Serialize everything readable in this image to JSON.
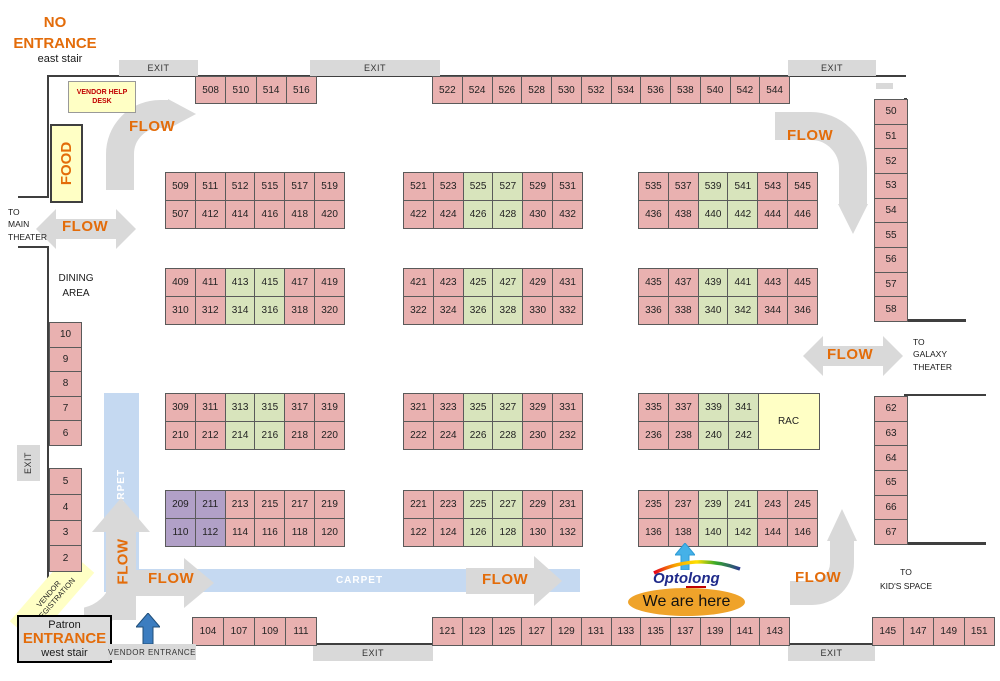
{
  "labels": {
    "no_entrance_1": "NO",
    "no_entrance_2": "ENTRANCE",
    "east_stair": "east stair",
    "exit": "EXIT",
    "flow": "FLOW",
    "vendor_help_1": "VENDOR HELP",
    "vendor_help_2": "DESK",
    "food": "FOOD",
    "to_main_1": "TO",
    "to_main_2": "MAIN",
    "to_main_3": "THEATER",
    "dining_1": "DINING",
    "dining_2": "AREA",
    "carpet": "CARPET",
    "to_galaxy_1": "TO",
    "to_galaxy_2": "GALAXY",
    "to_galaxy_3": "THEATER",
    "rac": "RAC",
    "to_kids_1": "TO",
    "to_kids_2": "KID'S SPACE",
    "vendor_reg_1": "VENDOR",
    "vendor_reg_2": "REGISTRATION",
    "patron_1": "Patron",
    "patron_2": "ENTRANCE",
    "patron_3": "west stair",
    "vendor_entrance": "VENDOR ENTRANCE",
    "we_are_here": "We are here",
    "optolong": "Optolong"
  },
  "colors": {
    "booth_pink": "#E9B1B0",
    "booth_green": "#D8E4BC",
    "booth_purple": "#B1A0C7",
    "highlight_yellow": "#FFFFC5",
    "flow_gray": "#D9D9D9",
    "carpet_blue": "#C5D9F1",
    "accent_orange": "#E36C0A",
    "wall_dark": "#3F3F3F",
    "help_desk_red": "#C00000",
    "entrance_arrow_blue": "#3C7DC0",
    "here_arrow_blue": "#45B1E8",
    "here_badge_orange": "#EFA32A"
  },
  "booths": {
    "row1_left": [
      [
        "508",
        "510",
        "514",
        "516"
      ]
    ],
    "row1_mid": [
      [
        "522",
        "524",
        "526",
        "528",
        "530",
        "532",
        "534",
        "536",
        "538",
        "540",
        "542",
        "544"
      ]
    ],
    "r2a": [
      [
        "509",
        "511",
        "512",
        "515",
        "517",
        "519"
      ],
      [
        "507",
        "412",
        "414",
        "416",
        "418",
        "420"
      ]
    ],
    "r2b": [
      [
        "521",
        "523",
        "525g",
        "527g",
        "529",
        "531"
      ],
      [
        "422",
        "424",
        "426g",
        "428g",
        "430",
        "432"
      ]
    ],
    "r2c": [
      [
        "535",
        "537",
        "539g",
        "541g",
        "543",
        "545"
      ],
      [
        "436",
        "438",
        "440g",
        "442g",
        "444",
        "446"
      ]
    ],
    "r3a": [
      [
        "409",
        "411",
        "413g",
        "415g",
        "417",
        "419"
      ],
      [
        "310",
        "312",
        "314g",
        "316g",
        "318",
        "320"
      ]
    ],
    "r3b": [
      [
        "421",
        "423",
        "425g",
        "427g",
        "429",
        "431"
      ],
      [
        "322",
        "324",
        "326g",
        "328g",
        "330",
        "332"
      ]
    ],
    "r3c": [
      [
        "435",
        "437",
        "439g",
        "441g",
        "443",
        "445"
      ],
      [
        "336",
        "338",
        "340g",
        "342g",
        "344",
        "346"
      ]
    ],
    "r4a": [
      [
        "309",
        "311",
        "313g",
        "315g",
        "317",
        "319"
      ],
      [
        "210",
        "212",
        "214g",
        "216g",
        "218",
        "220"
      ]
    ],
    "r4b": [
      [
        "321",
        "323",
        "325g",
        "327g",
        "329",
        "331"
      ],
      [
        "222",
        "224",
        "226g",
        "228g",
        "230",
        "232"
      ]
    ],
    "r4c": [
      [
        "335",
        "337",
        "339g",
        "341g"
      ],
      [
        "236",
        "238",
        "240g",
        "242g"
      ]
    ],
    "r5a": [
      [
        "209u",
        "211u",
        "213",
        "215",
        "217",
        "219"
      ],
      [
        "110u",
        "112u",
        "114",
        "116",
        "118",
        "120"
      ]
    ],
    "r5b": [
      [
        "221",
        "223",
        "225g",
        "227g",
        "229",
        "231"
      ],
      [
        "122",
        "124",
        "126g",
        "128g",
        "130",
        "132"
      ]
    ],
    "r5c": [
      [
        "235",
        "237",
        "239g",
        "241g",
        "243",
        "245"
      ],
      [
        "136",
        "138",
        "140g",
        "142g",
        "144",
        "146"
      ]
    ],
    "col_right_upper": [
      [
        "50"
      ],
      [
        "51"
      ],
      [
        "52"
      ],
      [
        "53"
      ],
      [
        "54"
      ],
      [
        "55"
      ],
      [
        "56"
      ],
      [
        "57"
      ],
      [
        "58"
      ]
    ],
    "col_right_lower": [
      [
        "62"
      ],
      [
        "63"
      ],
      [
        "64"
      ],
      [
        "65"
      ],
      [
        "66"
      ],
      [
        "67"
      ]
    ],
    "col_left_upper": [
      [
        "10"
      ],
      [
        "9"
      ],
      [
        "8"
      ],
      [
        "7"
      ],
      [
        "6"
      ]
    ],
    "col_left_lower": [
      [
        "5"
      ],
      [
        "4"
      ],
      [
        "3"
      ],
      [
        "2"
      ]
    ],
    "bottom_left": [
      [
        "104",
        "107",
        "109",
        "111"
      ]
    ],
    "bottom_mid": [
      [
        "121",
        "123",
        "125",
        "127",
        "129",
        "131",
        "133",
        "135",
        "137",
        "139",
        "141",
        "143"
      ]
    ],
    "bottom_right": [
      [
        "145",
        "147",
        "149",
        "151"
      ]
    ]
  }
}
